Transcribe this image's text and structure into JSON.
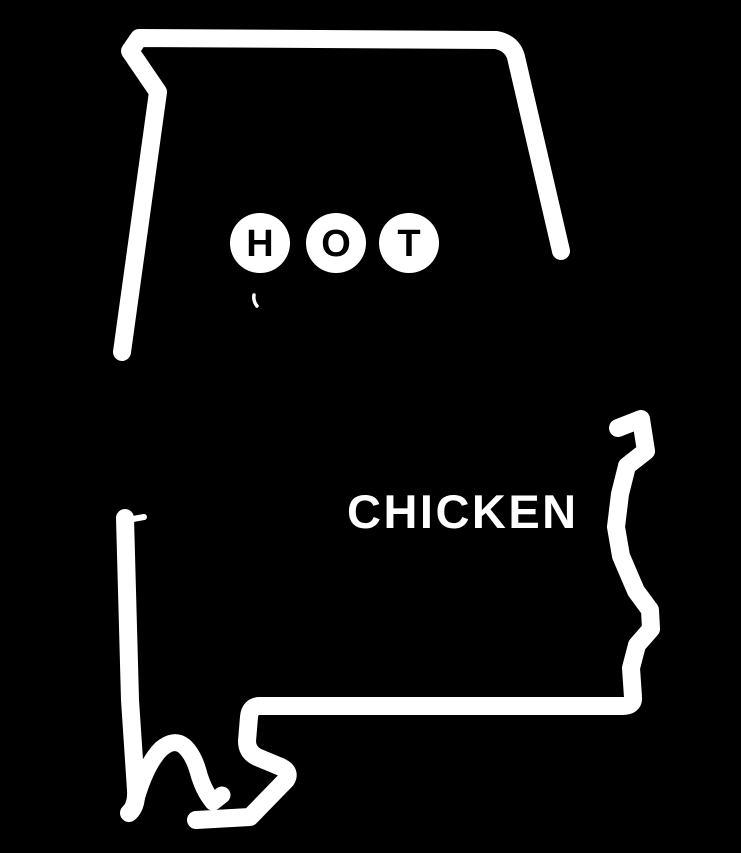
{
  "canvas": {
    "width_px": 741,
    "height_px": 853,
    "background_color": "#000000",
    "foreground_color": "#ffffff"
  },
  "logo": {
    "state_shape": "alabama-state-outline",
    "hot": {
      "word": "HOT",
      "letters": [
        "H",
        "O",
        "T"
      ]
    },
    "chicken_word": "CHICKEN"
  }
}
